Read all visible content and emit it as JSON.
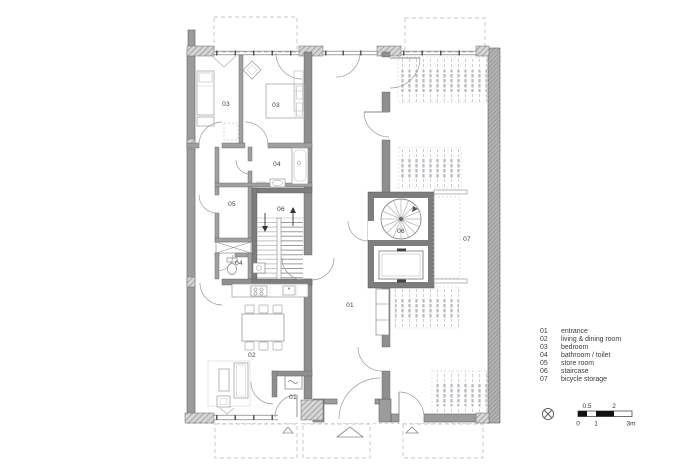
{
  "plan": {
    "room_labels": [
      "03",
      "03",
      "04",
      "05",
      "06",
      "04",
      "01",
      "02",
      "01",
      "06",
      "07"
    ]
  },
  "legend": {
    "items": [
      {
        "code": "01",
        "label": "entrance"
      },
      {
        "code": "02",
        "label": "living & dining room"
      },
      {
        "code": "03",
        "label": "bedroom"
      },
      {
        "code": "04",
        "label": "bathroom / toilet"
      },
      {
        "code": "05",
        "label": "store room"
      },
      {
        "code": "06",
        "label": "staircase"
      },
      {
        "code": "07",
        "label": "bicycle storage"
      }
    ]
  },
  "scale_bar": {
    "above": [
      "0.5",
      "2"
    ],
    "below": [
      "0",
      "1",
      "3m"
    ]
  },
  "icons": {
    "north_arrow": "circle-with-cross"
  },
  "colors": {
    "wall_grey": "#9c9c9c",
    "wall_mid": "#8f8f8f",
    "wall_dark": "#7d7d7d",
    "line": "#555555",
    "furniture": "#999999",
    "bike": "#c9c9cf",
    "dashed": "#c6c6c6",
    "text": "#3a3a3a",
    "scale_black": "#111111"
  }
}
